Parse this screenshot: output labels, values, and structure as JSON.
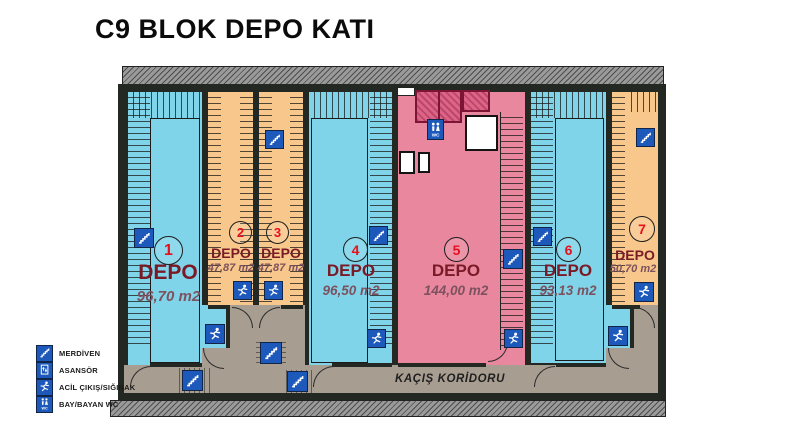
{
  "title": "C9 BLOK DEPO KATI",
  "corridor": {
    "label": "KAÇIŞ KORİDORU"
  },
  "wc_icon_label": "WC",
  "legend": {
    "items": [
      {
        "icon": "stairs-icon",
        "label": "MERDİVEN"
      },
      {
        "icon": "elevator-icon",
        "label": "ASANSÖR"
      },
      {
        "icon": "emergency-exit-icon",
        "label": "ACİL ÇIKIŞ/SIĞINAK"
      },
      {
        "icon": "wc-icon",
        "label": "BAY/BAYAN WC"
      }
    ]
  },
  "rooms": [
    {
      "number": "1",
      "name": "DEPO",
      "area": "96,70 m2",
      "color": "#7fd4e9"
    },
    {
      "number": "2",
      "name": "DEPO",
      "area": "47,87 m2",
      "color": "#f7c78b"
    },
    {
      "number": "3",
      "name": "DEPO",
      "area": "47,87 m2",
      "color": "#f7c78b"
    },
    {
      "number": "4",
      "name": "DEPO",
      "area": "96,50 m2",
      "color": "#7fd4e9"
    },
    {
      "number": "5",
      "name": "DEPO",
      "area": "144,00 m2",
      "color": "#e9879e"
    },
    {
      "number": "6",
      "name": "DEPO",
      "area": "93,13 m2",
      "color": "#7fd4e9"
    },
    {
      "number": "7",
      "name": "DEPO",
      "area": "50,70 m2",
      "color": "#f7c78b"
    }
  ],
  "colors": {
    "room_blue": "#7fd4e9",
    "room_orange": "#f7c78b",
    "room_pink": "#e9879e",
    "wc_block_pink": "#dd6486",
    "corridor_gray": "#a79d90",
    "wall_dark": "#232822",
    "icon_blue": "#1d58bb",
    "number_red": "#e8101c",
    "depo_maroon": "#7a1a26"
  }
}
